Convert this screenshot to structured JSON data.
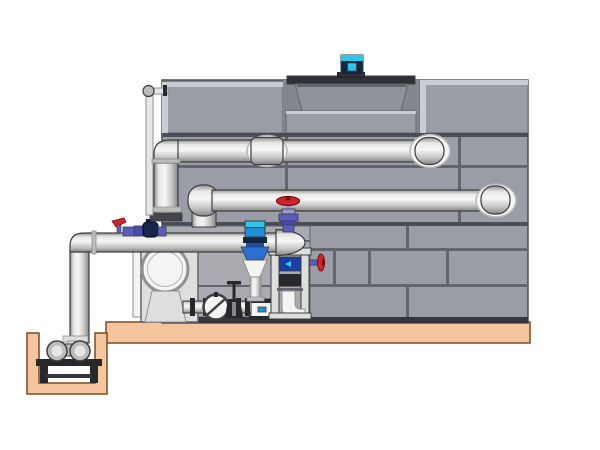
{
  "meta": {
    "description": "Technical side-view illustration of a closed-circuit cooling tower with paneled casing, top fan motor, return and supply pipes, pump skid with valves, control valve stand, and a sump pump in a pit on a concrete pad"
  },
  "components": [
    "concrete-pad",
    "sump-pit",
    "sump-pump",
    "pump-stand",
    "cooling-tower-casing",
    "fan-deck",
    "fan-cowl",
    "fan-motor",
    "tower-return-pipe",
    "tower-supply-pipe",
    "riser-pipe",
    "overflow-pipe",
    "pump-discharge-pipe",
    "pipe-dome-cap",
    "wall-escutcheon",
    "circulation-pump",
    "pump-cabinet",
    "check-valve",
    "gate-valve",
    "globe-valve",
    "lever-valve",
    "chemical-feed-assembly",
    "control-valve-actuator",
    "valve-stand",
    "handwheel-valve",
    "pump-base"
  ],
  "colors": {
    "background": "#ffffff",
    "platform": "#f5c69e",
    "platform_edge": "#7b4a21",
    "tower_panel": "#9a9da5",
    "tower_panel_light": "#c9ccd3",
    "tower_recess": "#85878f",
    "tower_line": "#63656d",
    "tower_divider": "#4b4d55",
    "tower_rail": "#35373d",
    "fan_deck": "#2e3036",
    "fan_cowl": "#90939b",
    "bay": "#a9abb1",
    "cabinet": "#dededc",
    "white_equipment": "#f4f4f2",
    "dark_metal": "#26282c",
    "pipe_flat": "#e6e6e4",
    "outline": "#3c3e42",
    "outline_soft": "#8f9193",
    "outline_black": "#000000",
    "ring": "#b5b7b9",
    "collar": "#bcbcba",
    "flange_dark": "#43454b",
    "valve_red": "#d2232b",
    "valve_red_dark": "#7a1016",
    "valve_purple": "#5b5bc2",
    "purple_dark": "#4a4ab0",
    "lavender": "#9a9ac8",
    "navy": "#16294a",
    "navy_dark": "#0d1b33",
    "actuator_blue": "#1f8ed6",
    "cyan": "#2fc6e8",
    "motor_body": "#122840",
    "blue_panel": "#1b3fa0",
    "trumpet_blue": "#2c6fd2",
    "trumpet_dark": "#1d4f9e",
    "pg0": "#8f8f8d",
    "pg1": "#e8e8e6",
    "pg2": "#f6f6f4",
    "pg3": "#c4c4c2",
    "pg4": "#86868a"
  }
}
